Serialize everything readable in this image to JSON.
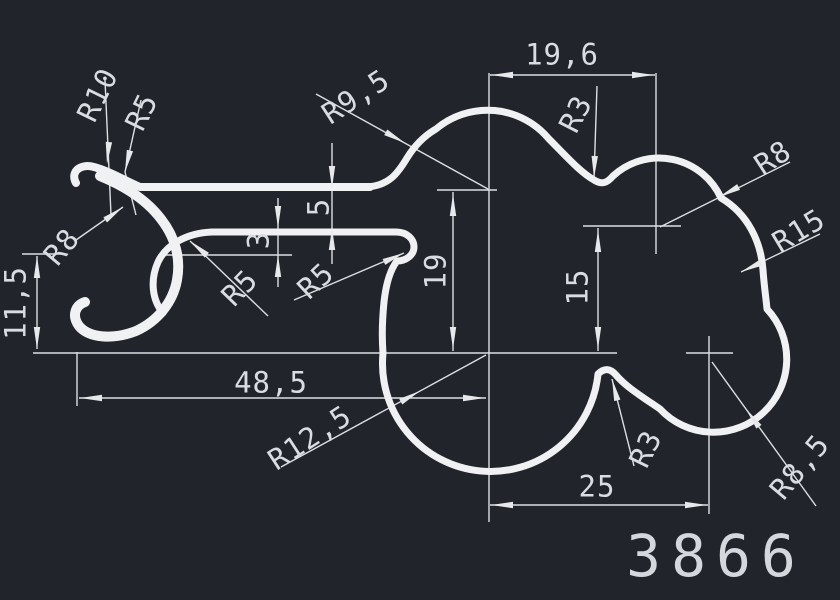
{
  "colors": {
    "background": "#21242a",
    "line": "#eff1f3",
    "text": "#d9dce0"
  },
  "part_number": "3866",
  "labels": {
    "r10": "R10",
    "r5_top": "R5",
    "r8_hook": "R8",
    "h11_5": "11,5",
    "r5_arm_left": "R5",
    "r5_arm_right": "R5",
    "t3": "3",
    "g5": "5",
    "r9_5": "R9,5",
    "v19": "19",
    "w48_5": "48,5",
    "r12_5": "R12,5",
    "w19_6": "19,6",
    "r3_top": "R3",
    "r8_top_lobe": "R8",
    "r15": "R15",
    "v15": "15",
    "w25": "25",
    "r3_bottom": "R3",
    "r8_5": "R8,5"
  },
  "drawing": {
    "type": "extrusion-profile-cross-section",
    "linear_dimensions": [
      "11,5",
      "48,5",
      "5",
      "3",
      "19",
      "15",
      "19,6",
      "25"
    ],
    "radius_dimensions": [
      "R10",
      "R5",
      "R8",
      "R5",
      "R5",
      "R9,5",
      "R3",
      "R8",
      "R15",
      "R12,5",
      "R3",
      "R8,5"
    ]
  }
}
